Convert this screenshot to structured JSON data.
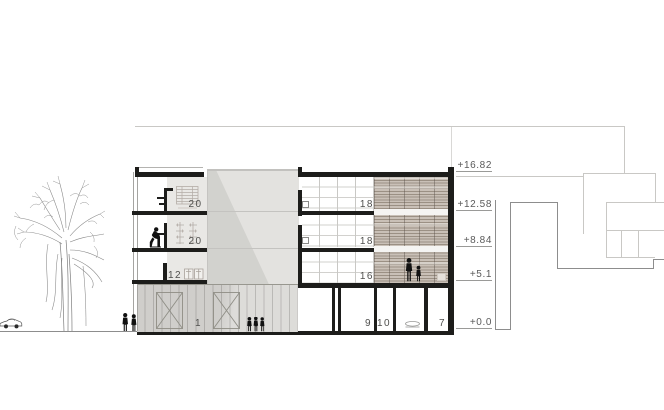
{
  "drawing": {
    "type": "architectural building section",
    "room_labels": {
      "f3_left": "20",
      "f2_left": "20",
      "f1_left": "12",
      "f3_right": "18",
      "f2_right": "18",
      "f1_right": "16",
      "ground_hall": "1",
      "ground_room_a": "9",
      "ground_room_b": "10",
      "ground_room_c": "7"
    },
    "elevations": [
      {
        "label": "+16.82"
      },
      {
        "label": "+12.58"
      },
      {
        "label": "+8.84"
      },
      {
        "label": "+5.1"
      },
      {
        "label": "+0.0"
      }
    ],
    "colors": {
      "ink": "#1d1d1b",
      "concrete_mass": "#e3e2df",
      "ground_facade": "#dddcd9",
      "louver_dark": "#9b9084",
      "louver_light": "#c9c0b7",
      "outline_light": "#c9c8c5",
      "outline_mid": "#8d8d8d",
      "label_gray": "#5a5a5a"
    }
  }
}
